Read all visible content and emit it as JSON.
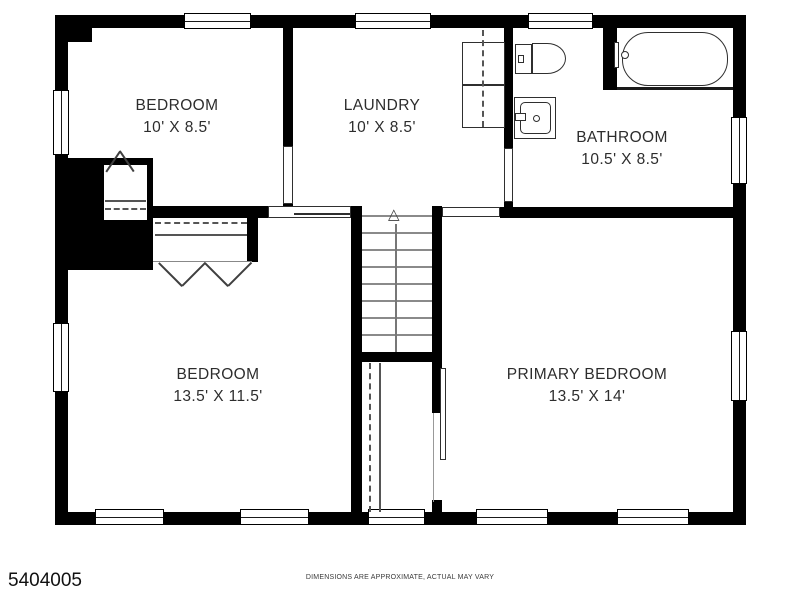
{
  "rooms": [
    {
      "name": "BEDROOM",
      "dims": "10' X 8.5'"
    },
    {
      "name": "LAUNDRY",
      "dims": "10' X 8.5'"
    },
    {
      "name": "BATHROOM",
      "dims": "10.5' X 8.5'"
    },
    {
      "name": "BEDROOM",
      "dims": "13.5' X 11.5'"
    },
    {
      "name": "PRIMARY BEDROOM",
      "dims": "13.5' X 14'"
    }
  ],
  "stairs": {
    "arrow_glyph": "△"
  },
  "fixtures": [
    "bathtub",
    "toilet",
    "sink",
    "washer",
    "dryer",
    "staircase",
    "closet-rods"
  ],
  "footer": {
    "mls_number": "5404005",
    "disclaimer": "DIMENSIONS ARE APPROXIMATE, ACTUAL MAY VARY"
  },
  "colors": {
    "wall": "#000000",
    "line": "#555555",
    "text": "#2d2d2d",
    "background": "#ffffff"
  }
}
